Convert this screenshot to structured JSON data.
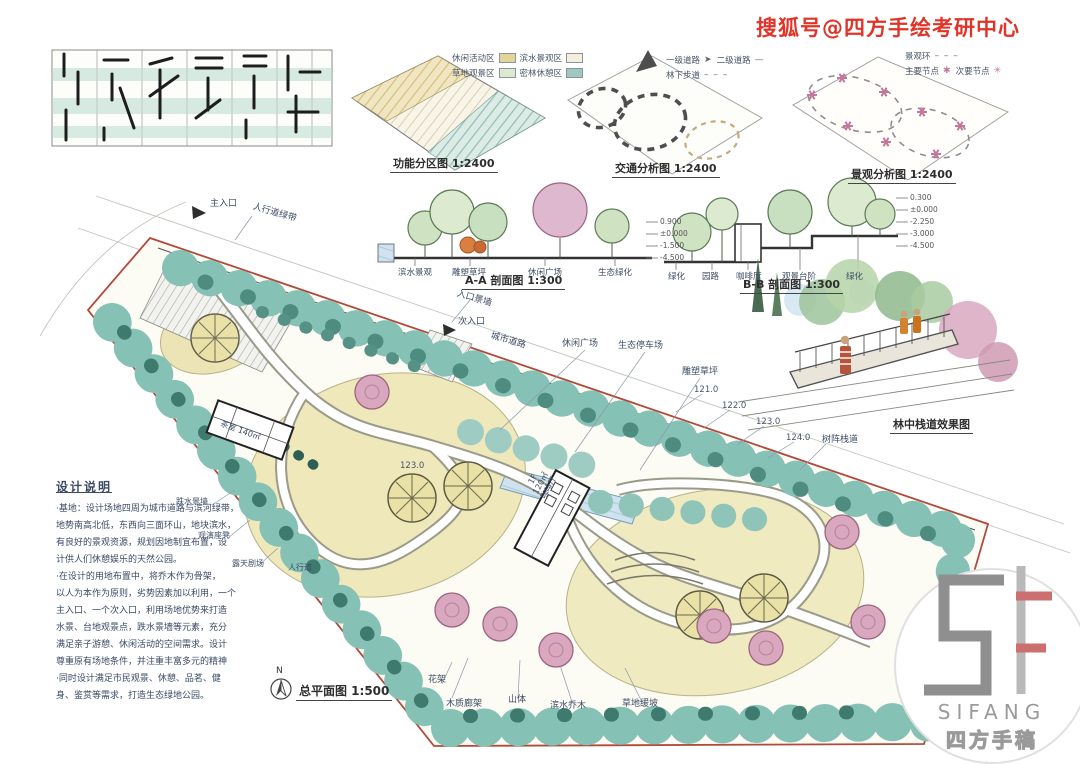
{
  "watermark": "搜狐号@四方手绘考研中心",
  "diagrams": {
    "function": {
      "caption": "功能分区图 1:2400",
      "legend": [
        {
          "label": "休闲活动区",
          "color": "#e3d49a"
        },
        {
          "label": "滨水景观区",
          "color": "#f4efdd"
        },
        {
          "label": "草地观景区",
          "color": "#dde8cd"
        },
        {
          "label": "密林休憩区",
          "color": "#9ec8bf"
        }
      ]
    },
    "traffic": {
      "caption": "交通分析图 1:2400",
      "legend": [
        {
          "label": "一级道路",
          "sample": "➤"
        },
        {
          "label": "二级道路",
          "sample": "—"
        },
        {
          "label": "林下步道",
          "sample": "– – –"
        }
      ]
    },
    "landscape": {
      "caption": "景观分析图 1:2400",
      "legend": [
        {
          "label": "景观环",
          "sample": "– – –"
        },
        {
          "label": "主要节点",
          "sample": "✱"
        },
        {
          "label": "次要节点",
          "sample": "✳"
        }
      ]
    }
  },
  "sections": {
    "aa": {
      "caption": "A-A 剖面图 1:300",
      "labels": [
        "滨水景观",
        "雕塑草坪",
        "休闲广场",
        "生态绿化"
      ],
      "elevations": [
        "0.900",
        "±0.000",
        "-1.500",
        "-4.500"
      ]
    },
    "bb": {
      "caption": "B-B 剖面图 1:300",
      "labels": [
        "绿化",
        "园路",
        "咖啡厅",
        "观景台阶",
        "绿化"
      ],
      "elevations": [
        "0.300",
        "±0.000",
        "-2.250",
        "-3.000",
        "-4.500"
      ]
    }
  },
  "perspective": {
    "caption": "林中栈道效果图"
  },
  "plan": {
    "caption": "总平面图 1:500",
    "north": "N",
    "labels": {
      "main_entrance": "主入口",
      "sidewalk": "人行道绿带",
      "entry_wall": "入口景墙",
      "secondary_entrance": "次入口",
      "city_road": "城市道路",
      "leisure_plaza": "休闲广场",
      "eco_parking": "生态停车场",
      "sculpture_lawn": "雕塑草坪",
      "boardwalk": "树阵栈道",
      "tea_house": "茶室 140㎡",
      "cafe": "1F\n120㎡\n咖啡厅",
      "water_wall": "跌水景墙",
      "seating": "观演座凳",
      "theater": "露天剧场",
      "footpath": "人行道",
      "trellis": "花架",
      "wood_gallery": "木质廊架",
      "hill": "山体",
      "waterside_trees": "滨水乔木",
      "lawn_slope": "草地缓坡",
      "lawn_elev": "123.0"
    },
    "elevations": [
      "121.0",
      "122.0",
      "123.0",
      "124.0"
    ]
  },
  "notes": {
    "title": "设计说明",
    "lines": [
      "·基地：设计场地四周为城市道路与滨河绿带，",
      "地势南高北低，东西向三面环山，地块滨水，",
      "有良好的景观资源，规划因地制宜布置，设",
      "计供人们休憩娱乐的天然公园。",
      "·在设计的用地布置中，将乔木作为骨架，",
      "以人为本作为原则，劣势因素加以利用，一个",
      "主入口、一个次入口，利用场地优势来打造",
      "水景、台地观景点，跌水景墙等元素，充分",
      "满足亲子游憩、休闲活动的空间需求。设计",
      "尊重原有场地条件，并注重丰富多元的精神",
      "·同时设计满足市民观景、休憩、品茗、健",
      "身、鉴赏等需求，打造生态绿地公园。"
    ]
  },
  "logo": {
    "name": "SIFANG",
    "cn": "四方手稿"
  }
}
